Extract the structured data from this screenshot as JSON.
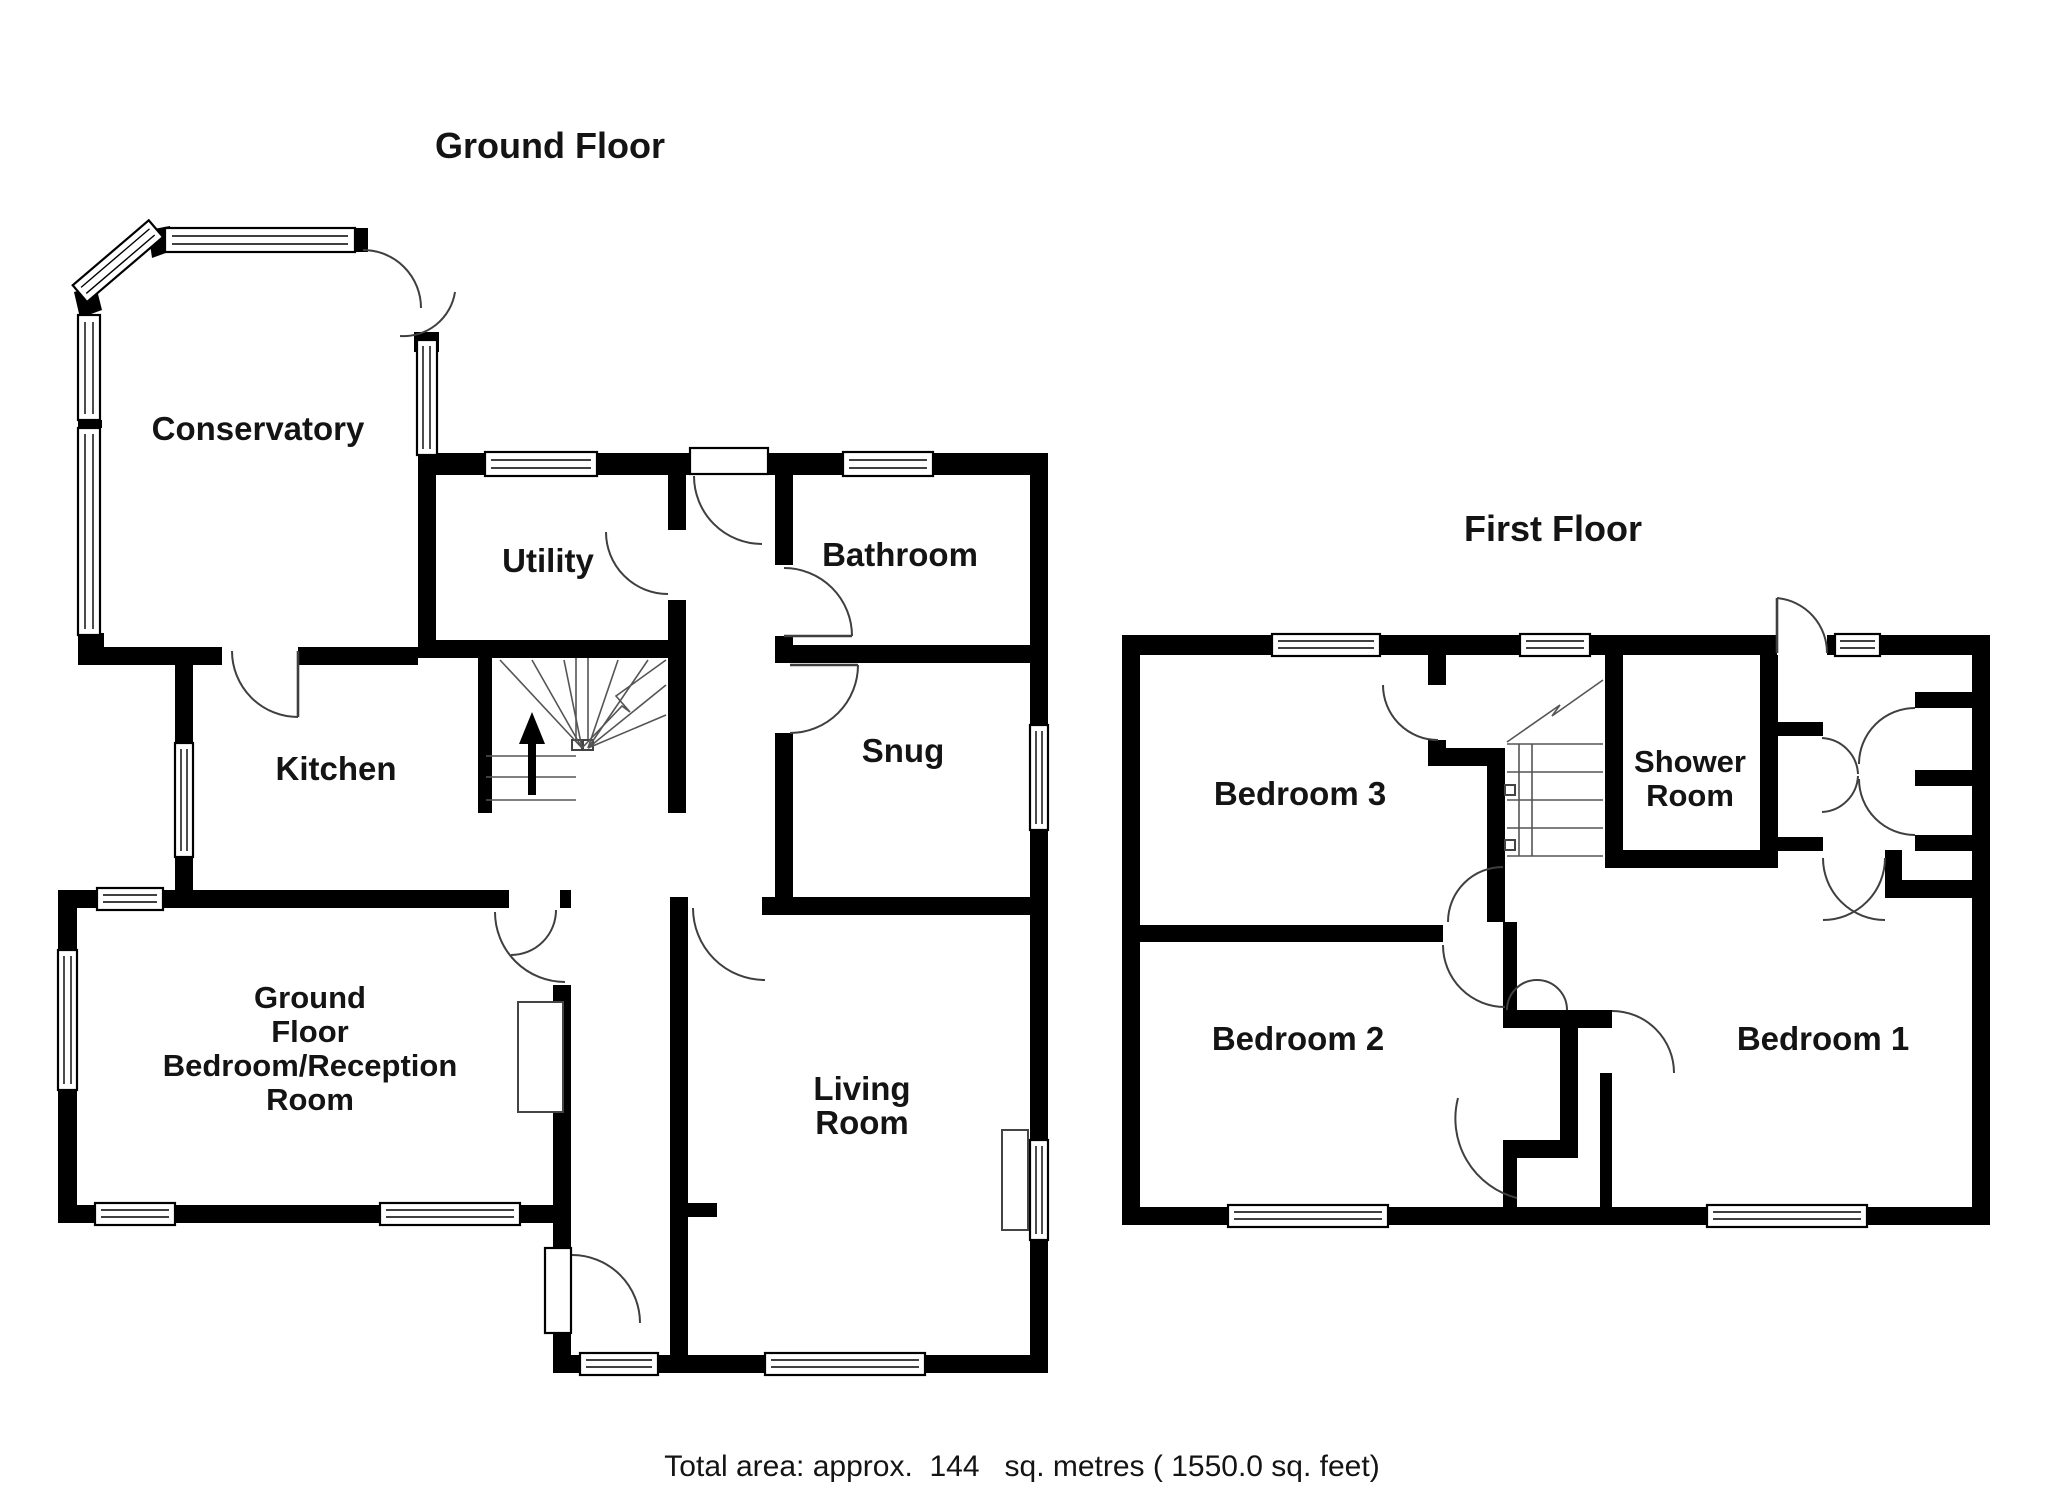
{
  "titles": {
    "ground_floor": "Ground Floor",
    "first_floor": "First Floor"
  },
  "ground_floor_rooms": {
    "conservatory": "Conservatory",
    "utility": "Utility",
    "bathroom": "Bathroom",
    "kitchen": "Kitchen",
    "snug": "Snug",
    "reception_line1": "Ground",
    "reception_line2": "Floor",
    "reception_line3": "Bedroom/Reception",
    "reception_line4": "Room",
    "living_line1": "Living",
    "living_line2": "Room"
  },
  "first_floor_rooms": {
    "bedroom3": "Bedroom 3",
    "shower_line1": "Shower",
    "shower_line2": "Room",
    "bedroom2": "Bedroom 2",
    "bedroom1": "Bedroom 1"
  },
  "footer": {
    "total_area": "Total area: approx.  144   sq. metres ( 1550.0 sq. feet)"
  },
  "symbols": {
    "stairs_direction": "up-arrow"
  },
  "colors": {
    "wall": "#000000",
    "door_line": "#3f3f3f",
    "background": "#ffffff"
  }
}
